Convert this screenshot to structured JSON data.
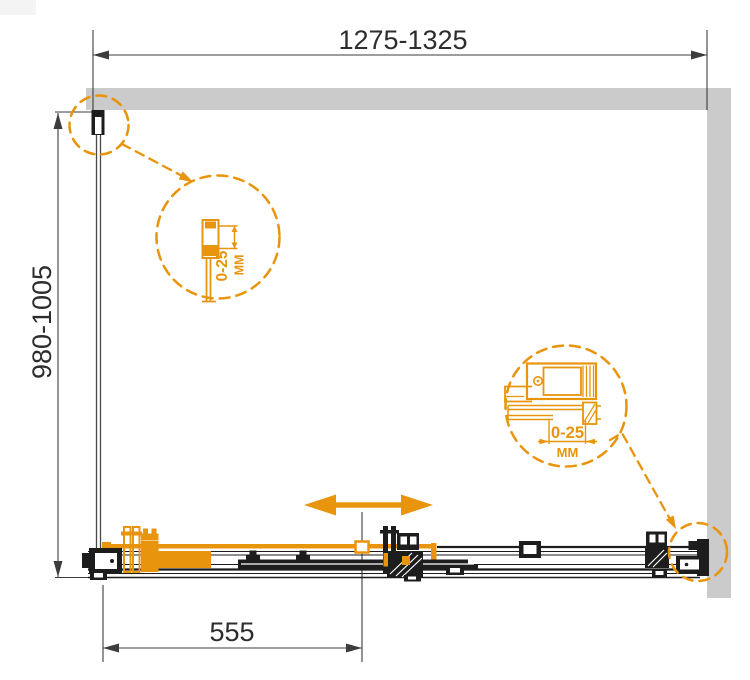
{
  "drawing": {
    "type": "shower-enclosure-installation-diagram",
    "colors": {
      "accent_orange": "#e8940c",
      "wall_gray": "#cbcbcb",
      "line_black": "#1d1d1d",
      "dimension_text": "#2d2d2d"
    },
    "dimensions": {
      "width": {
        "value": "1275-1325"
      },
      "height": {
        "value": "980-1005"
      },
      "door": {
        "value": "555"
      }
    },
    "details": {
      "left_profile": {
        "range": "0-25",
        "unit": "ММ"
      },
      "right_profile": {
        "range": "0-25",
        "unit": "ММ"
      }
    },
    "icons": {
      "slide_direction": "double-headed-arrow"
    }
  }
}
